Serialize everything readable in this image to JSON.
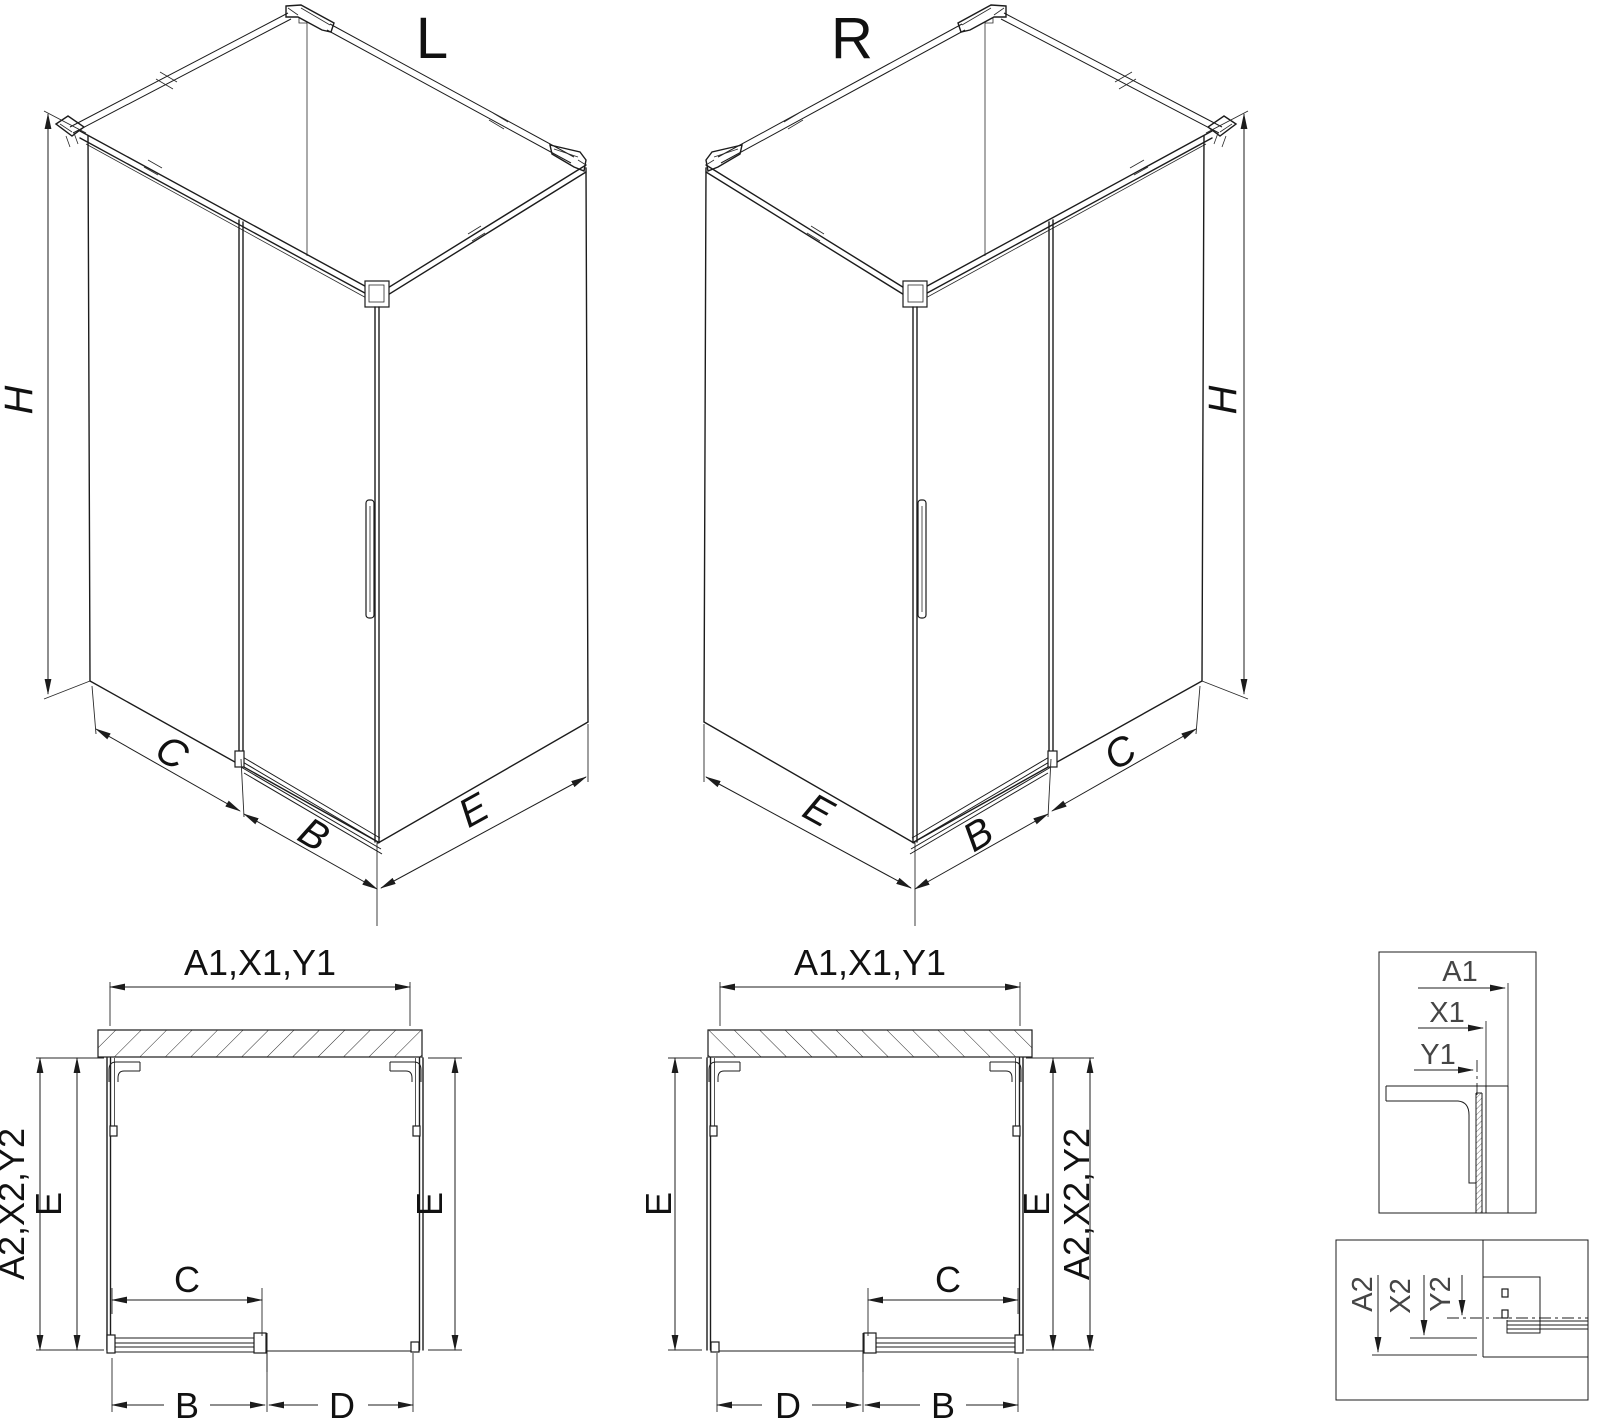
{
  "drawing": {
    "iso_left": {
      "title": "L",
      "dim_height": "H",
      "dim_fixed": "C",
      "dim_door": "B",
      "dim_side": "E"
    },
    "iso_right": {
      "title": "R",
      "dim_height": "H",
      "dim_fixed": "C",
      "dim_door": "B",
      "dim_side": "E"
    },
    "plan_left": {
      "dim_width_top": "A1,X1,Y1",
      "dim_depth_side": "A2,X2,Y2",
      "dim_e_left": "E",
      "dim_e_right": "E",
      "dim_c": "C",
      "dim_b": "B",
      "dim_d": "D"
    },
    "plan_right": {
      "dim_width_top": "A1,X1,Y1",
      "dim_depth_side": "A2,X2,Y2",
      "dim_e_left": "E",
      "dim_e_right": "E",
      "dim_c": "C",
      "dim_b": "B",
      "dim_d": "D"
    },
    "detail_width": {
      "a1": "A1",
      "x1": "X1",
      "y1": "Y1"
    },
    "detail_depth": {
      "a2": "A2",
      "x2": "X2",
      "y2": "Y2"
    }
  }
}
